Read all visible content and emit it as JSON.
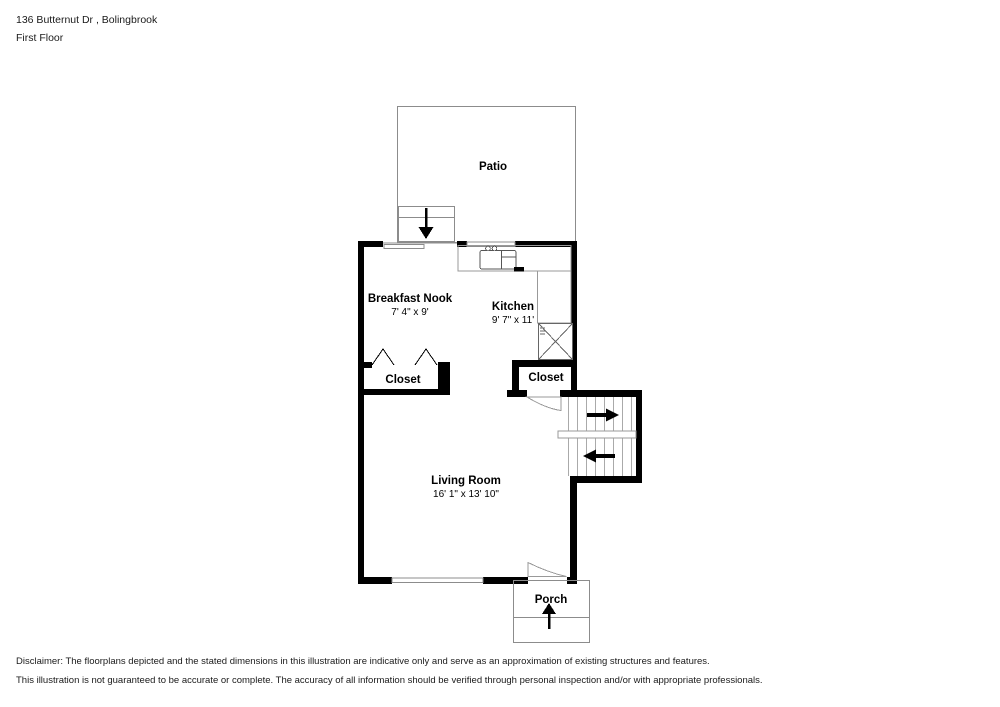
{
  "header": {
    "address": "136 Butternut Dr , Bolingbrook",
    "floor": "First Floor"
  },
  "rooms": {
    "patio": {
      "name": "Patio"
    },
    "breakfast_nook": {
      "name": "Breakfast Nook",
      "dimensions": "7' 4\" x 9'"
    },
    "kitchen": {
      "name": "Kitchen",
      "dimensions": "9' 7\" x 11'"
    },
    "closet_left": {
      "name": "Closet"
    },
    "closet_right": {
      "name": "Closet"
    },
    "living_room": {
      "name": "Living Room",
      "dimensions": "16' 1\" x 13' 10\""
    },
    "porch": {
      "name": "Porch"
    }
  },
  "disclaimer": {
    "line1": "Disclaimer: The floorplans depicted and the stated dimensions in this illustration are indicative only and serve as an approximation of existing structures and features.",
    "line2": "This illustration is not guaranteed to be accurate or complete. The accuracy of all information should be verified through personal inspection and/or with appropriate professionals."
  },
  "colors": {
    "wall": "#000000",
    "thin_line": "#8c8c8c",
    "fixture_line": "#666666",
    "background": "#ffffff",
    "text": "#1a1a1a"
  }
}
